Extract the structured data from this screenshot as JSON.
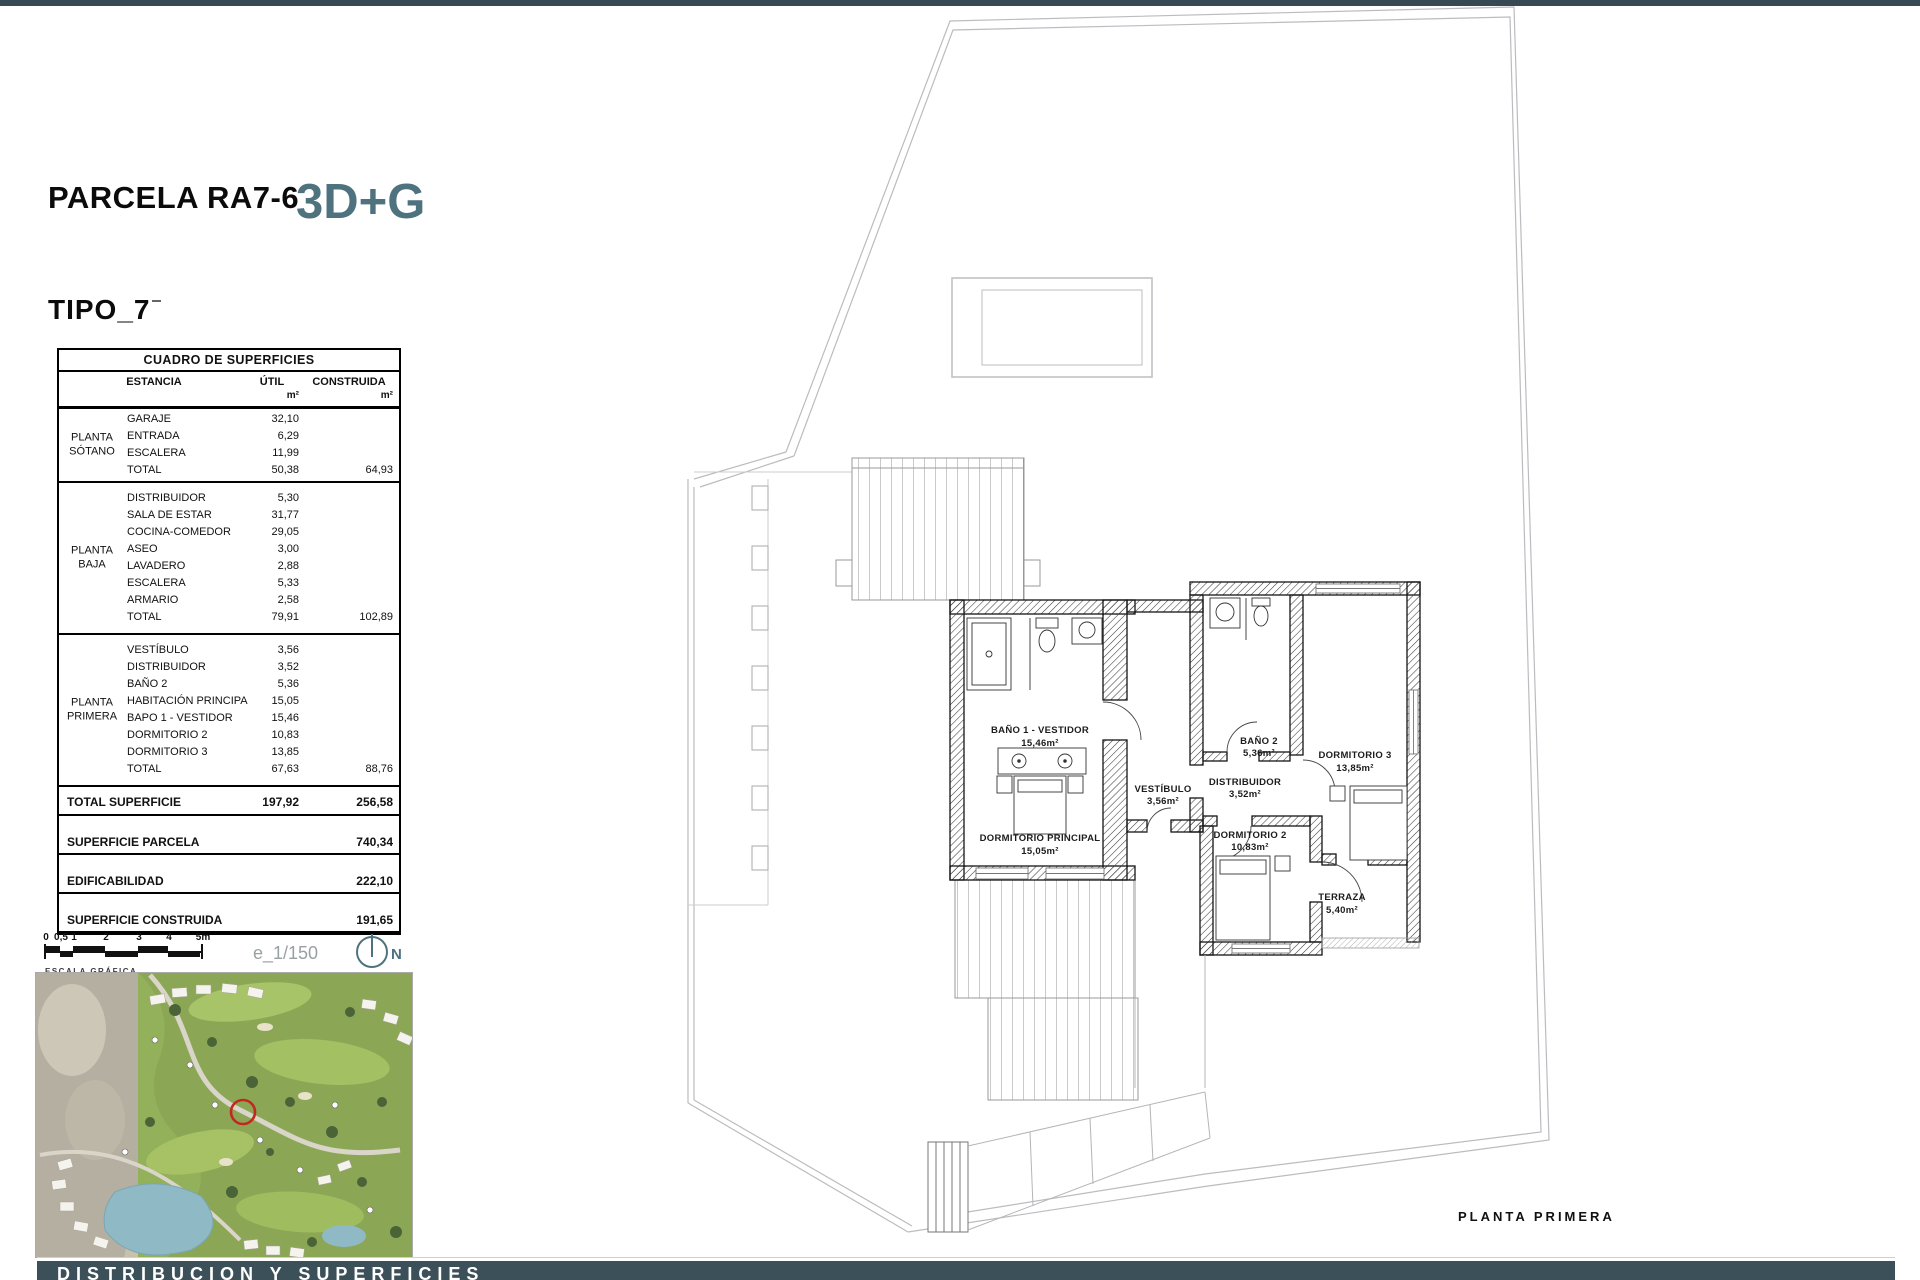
{
  "page": {
    "title": "PARCELA RA7-6",
    "badge": "3D+G",
    "type_label": "TIPO_7"
  },
  "footer": {
    "label": "DISTRIBUCION Y SUPERFICIES"
  },
  "colors": {
    "accent_teal": "#4e737e",
    "footer_bar": "#3c5059",
    "top_bar": "#374a54",
    "map_marker_red": "#c3271f"
  },
  "scale": {
    "ticks": [
      "0",
      "0,5",
      "1",
      "2",
      "3",
      "4",
      "5m"
    ],
    "caption": "ESCALA GRÁFICA",
    "ratio": "e_1/150",
    "north_label": "N",
    "north_icon": "compass-circle-icon"
  },
  "table": {
    "title": "CUADRO DE SUPERFICIES",
    "columns": {
      "estancia": "ESTANCIA",
      "util": "ÚTIL",
      "construida": "CONSTRUIDA"
    },
    "unit": "m²",
    "sections": [
      {
        "floor": "PLANTA SÓTANO",
        "rows": [
          [
            "GARAJE",
            "32,10"
          ],
          [
            "ENTRADA",
            "6,29"
          ],
          [
            "ESCALERA",
            "11,99"
          ]
        ],
        "total": [
          "TOTAL",
          "50,38",
          "64,93"
        ]
      },
      {
        "floor": "PLANTA BAJA",
        "rows": [
          [
            "DISTRIBUIDOR",
            "5,30"
          ],
          [
            "SALA DE ESTAR",
            "31,77"
          ],
          [
            "COCINA-COMEDOR",
            "29,05"
          ],
          [
            "ASEO",
            "3,00"
          ],
          [
            "LAVADERO",
            "2,88"
          ],
          [
            "ESCALERA",
            "5,33"
          ],
          [
            "ARMARIO",
            "2,58"
          ]
        ],
        "total": [
          "TOTAL",
          "79,91",
          "102,89"
        ]
      },
      {
        "floor": "PLANTA PRIMERA",
        "rows": [
          [
            "VESTÍBULO",
            "3,56"
          ],
          [
            "DISTRIBUIDOR",
            "3,52"
          ],
          [
            "BAÑO 2",
            "5,36"
          ],
          [
            "HABITACIÓN PRINCIPA",
            "15,05"
          ],
          [
            "BAPO 1 - VESTIDOR",
            "15,46"
          ],
          [
            "DORMITORIO 2",
            "10,83"
          ],
          [
            "DORMITORIO 3",
            "13,85"
          ]
        ],
        "total": [
          "TOTAL",
          "67,63",
          "88,76"
        ]
      }
    ],
    "summary": [
      {
        "label": "TOTAL SUPERFICIE",
        "util": "197,92",
        "construida": "256,58"
      },
      {
        "label": "SUPERFICIE PARCELA",
        "util": "",
        "construida": "740,34"
      },
      {
        "label": "EDIFICABILIDAD",
        "util": "",
        "construida": "222,10"
      },
      {
        "label": "SUPERFICIE CONSTRUIDA",
        "util": "",
        "construida": "191,65"
      }
    ]
  },
  "plan": {
    "caption": "PLANTA  PRIMERA",
    "rooms": [
      {
        "name": "BAÑO 1 - VESTIDOR",
        "area": "15,46m²"
      },
      {
        "name": "VESTÍBULO",
        "area": "3,56m²"
      },
      {
        "name": "BAÑO 2",
        "area": "5,36m²"
      },
      {
        "name": "DORMITORIO 3",
        "area": "13,85m²"
      },
      {
        "name": "DISTRIBUIDOR",
        "area": "3,52m²"
      },
      {
        "name": "DORMITORIO PRINCIPAL",
        "area": "15,05m²"
      },
      {
        "name": "DORMITORIO 2",
        "area": "10,83m²"
      },
      {
        "name": "TERRAZA",
        "area": "5,40m²"
      }
    ]
  }
}
